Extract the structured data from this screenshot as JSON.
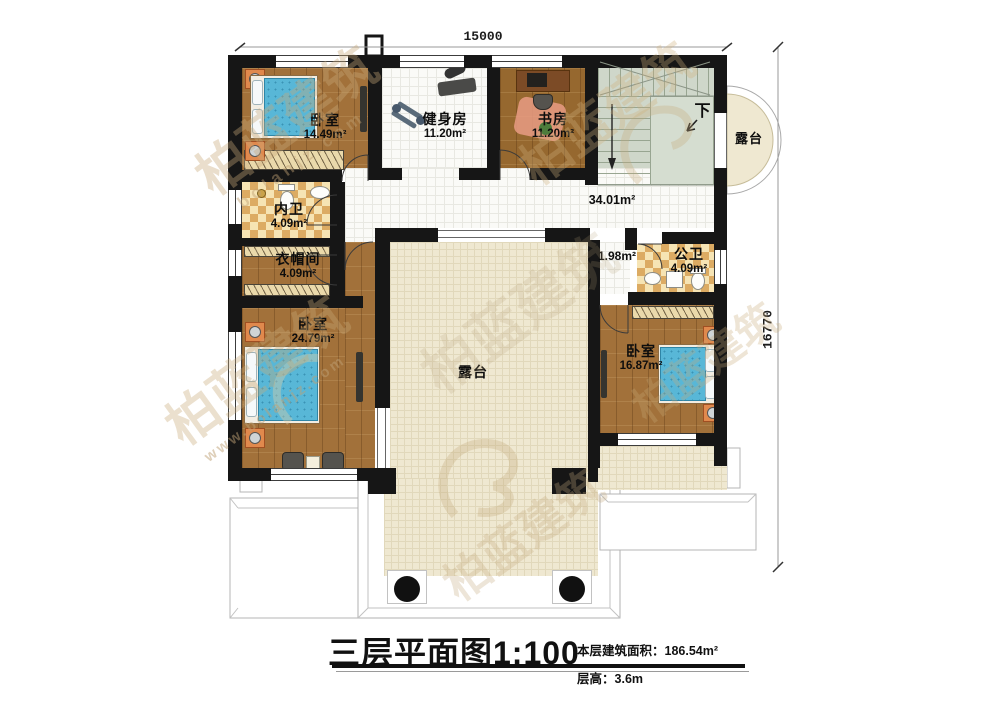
{
  "title": {
    "main": "三层平面图1:100",
    "area_label": "本层建筑面积：",
    "area_value": "186.54m²",
    "height_label": "层高：",
    "height_value": "3.6m"
  },
  "dimensions": {
    "width": "15000",
    "height": "16770"
  },
  "rooms": {
    "bedroom_top": {
      "name": "卧室",
      "area": "14.49m²"
    },
    "gym": {
      "name": "健身房",
      "area": "11.20m²"
    },
    "study": {
      "name": "书房",
      "area": "11.20m²"
    },
    "inner_bath": {
      "name": "内卫",
      "area": "4.09m²"
    },
    "cloakroom": {
      "name": "衣帽间",
      "area": "4.09m²"
    },
    "bedroom_left": {
      "name": "卧室",
      "area": "24.79m²"
    },
    "public_bath": {
      "name": "公卫",
      "area": "4.09m²"
    },
    "bedroom_right": {
      "name": "卧室",
      "area": "16.87m²"
    },
    "hallway": {
      "area": "34.01m²"
    },
    "passage": {
      "area": "1.98m²"
    },
    "terrace_center": {
      "name": "露台"
    },
    "terrace_right": {
      "name": "露台"
    },
    "stairs": {
      "label": "下"
    }
  },
  "watermark": {
    "brand": "柏蓝建筑",
    "site": "bolanjz.com",
    "site_full": "www.bolanjz.com"
  }
}
